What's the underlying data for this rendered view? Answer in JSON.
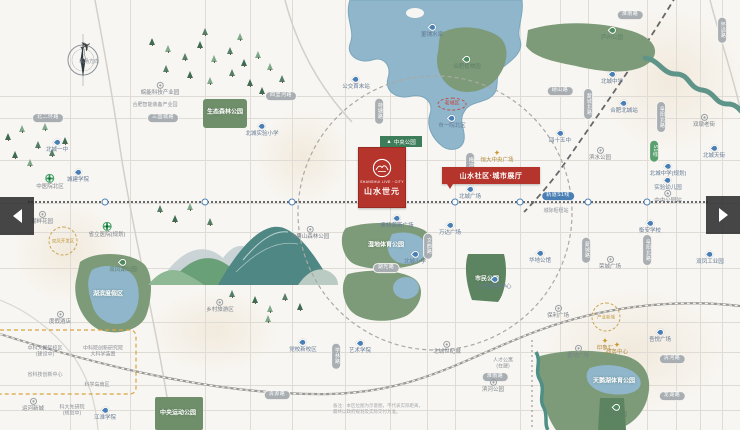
{
  "project": {
    "tag": "中央公园",
    "name_en": "SHANSHUI LIVE · CITY",
    "name_cn": "山水世元",
    "banner": "山水社区·城市展厅"
  },
  "disclaimer": {
    "line1": "备注：本区位图为示意图，不代表实际距离，",
    "line2": "最终以政府规划及实际交付为准。"
  },
  "metro": {
    "y": 201,
    "label": "轨道S1线",
    "stations": [
      105,
      205,
      292,
      390,
      455,
      520,
      588,
      647
    ]
  },
  "grid": {
    "v": [
      70,
      130,
      205,
      250,
      292,
      345,
      390,
      427,
      455,
      520,
      560,
      588,
      647,
      676,
      700,
      722
    ],
    "h": [
      96,
      118,
      160,
      203,
      232,
      268,
      322,
      352,
      385,
      410
    ]
  },
  "colors": {
    "accent_red": "#b5342c",
    "park_green": "#7d9b78",
    "lake_blue": "#8fb6ca",
    "pin_blue": "#4a7fb5"
  },
  "nav": {
    "prev_icon": "left-triangle",
    "next_icon": "right-triangle"
  },
  "labels": [
    {
      "x": 89,
      "y": 63,
      "k": "tx",
      "t": "机场方向"
    },
    {
      "x": 160,
      "y": 89,
      "k": "pc",
      "t": "皖能科技产业园"
    },
    {
      "x": 155,
      "y": 106,
      "k": "tx",
      "t": "合肥智能装备产业园"
    },
    {
      "x": 48,
      "y": 118,
      "k": "rh",
      "t": "北二环路"
    },
    {
      "x": 163,
      "y": 118,
      "k": "rh",
      "t": "三国城路"
    },
    {
      "x": 225,
      "y": 113,
      "k": "mw",
      "t": "生态森林公园"
    },
    {
      "x": 262,
      "y": 130,
      "k": "pb",
      "t": "北城实验小学"
    },
    {
      "x": 432,
      "y": 31,
      "k": "pb",
      "t": "董铺水库"
    },
    {
      "x": 467,
      "y": 63,
      "k": "pg",
      "t": "合肥植物园"
    },
    {
      "x": 356,
      "y": 83,
      "k": "pb",
      "t": "公交首末站"
    },
    {
      "x": 281,
      "y": 96,
      "k": "rh",
      "t": "四里河路"
    },
    {
      "x": 452,
      "y": 104,
      "k": "re",
      "t": "老城区"
    },
    {
      "x": 452,
      "y": 122,
      "k": "pb",
      "t": "市一院北区"
    },
    {
      "x": 560,
      "y": 91,
      "k": "rh",
      "t": "砀山路"
    },
    {
      "x": 612,
      "y": 34,
      "k": "pg",
      "t": "庐州公园"
    },
    {
      "x": 630,
      "y": 15,
      "k": "rh",
      "t": "淮南路"
    },
    {
      "x": 612,
      "y": 78,
      "k": "pb",
      "t": "北城中学"
    },
    {
      "x": 588,
      "y": 104,
      "k": "rv",
      "t": "蒙城北路"
    },
    {
      "x": 624,
      "y": 107,
      "k": "pb",
      "t": "合肥北城站"
    },
    {
      "x": 661,
      "y": 117,
      "k": "rv",
      "t": "阜阳北路"
    },
    {
      "x": 704,
      "y": 121,
      "k": "pc",
      "t": "双墩老街"
    },
    {
      "x": 722,
      "y": 30,
      "k": "rv",
      "t": "怀远路"
    },
    {
      "x": 560,
      "y": 137,
      "k": "pb",
      "t": "四十五中"
    },
    {
      "x": 600,
      "y": 154,
      "k": "pc",
      "t": "滨水公园"
    },
    {
      "x": 654,
      "y": 151,
      "k": "rg",
      "t": "S1线"
    },
    {
      "x": 668,
      "y": 170,
      "k": "pb",
      "t": "北城中学(规划)"
    },
    {
      "x": 668,
      "y": 184,
      "k": "pb",
      "t": "实验幼儿园"
    },
    {
      "x": 558,
      "y": 196,
      "k": "mt",
      "t": "轨道S1线"
    },
    {
      "x": 556,
      "y": 212,
      "k": "tx",
      "t": "城际枢纽站"
    },
    {
      "x": 668,
      "y": 197,
      "k": "pc",
      "t": "中央公园站"
    },
    {
      "x": 586,
      "y": 250,
      "k": "rv",
      "t": "蒙城路"
    },
    {
      "x": 647,
      "y": 250,
      "k": "rv",
      "t": "阜阳北路"
    },
    {
      "x": 650,
      "y": 227,
      "k": "pb",
      "t": "衡安学校"
    },
    {
      "x": 610,
      "y": 263,
      "k": "pc",
      "t": "荣城广场"
    },
    {
      "x": 714,
      "y": 152,
      "k": "pb",
      "t": "北城天街"
    },
    {
      "x": 710,
      "y": 258,
      "k": "pb",
      "t": "双凤工业园"
    },
    {
      "x": 379,
      "y": 111,
      "k": "rv",
      "t": "荷塘路"
    },
    {
      "x": 470,
      "y": 168,
      "k": "rv",
      "t": "梅冲湖路"
    },
    {
      "x": 497,
      "y": 157,
      "k": "st",
      "t": "恒大中央广场"
    },
    {
      "x": 470,
      "y": 193,
      "k": "pb",
      "t": "北城广场"
    },
    {
      "x": 397,
      "y": 222,
      "k": "pb",
      "t": "奥特莱斯广场"
    },
    {
      "x": 450,
      "y": 229,
      "k": "pb",
      "t": "万达广场"
    },
    {
      "x": 415,
      "y": 258,
      "k": "pb",
      "t": "北城小学"
    },
    {
      "x": 386,
      "y": 246,
      "k": "mw",
      "t": "湿地体育公园"
    },
    {
      "x": 487,
      "y": 280,
      "k": "mw",
      "t": "市民公园"
    },
    {
      "x": 540,
      "y": 257,
      "k": "pb",
      "t": "华地公馆"
    },
    {
      "x": 495,
      "y": 283,
      "k": "pb",
      "t": "社区服务中心"
    },
    {
      "x": 386,
      "y": 268,
      "k": "rh",
      "t": "湖光路"
    },
    {
      "x": 428,
      "y": 246,
      "k": "rv",
      "t": "文曲路"
    },
    {
      "x": 310,
      "y": 233,
      "k": "pc",
      "t": "大蜀山森林公园"
    },
    {
      "x": 57,
      "y": 146,
      "k": "pb",
      "t": "北城一中"
    },
    {
      "x": 50,
      "y": 182,
      "k": "hp",
      "t": "中医院北区"
    },
    {
      "x": 78,
      "y": 176,
      "k": "pb",
      "t": "城建学院"
    },
    {
      "x": 107,
      "y": 230,
      "k": "hp",
      "t": "省立医院(规划)"
    },
    {
      "x": 42,
      "y": 218,
      "k": "pc",
      "t": "湖畔花园"
    },
    {
      "x": 63,
      "y": 241,
      "k": "gd",
      "t": "双凤开发区"
    },
    {
      "x": 123,
      "y": 266,
      "k": "pg",
      "t": "双凤湖公园"
    },
    {
      "x": 108,
      "y": 295,
      "k": "mw",
      "t": "湖滨度假区"
    },
    {
      "x": 60,
      "y": 318,
      "k": "pc",
      "t": "度假酒店"
    },
    {
      "x": 45,
      "y": 352,
      "k": "t2",
      "t": "中科大国际校区\n(建设中)"
    },
    {
      "x": 103,
      "y": 352,
      "k": "t2",
      "t": "中科院创新研究院\n大科学装置"
    },
    {
      "x": 45,
      "y": 376,
      "k": "tx",
      "t": "省科技创新中心"
    },
    {
      "x": 97,
      "y": 386,
      "k": "tx",
      "t": "科学岛南区"
    },
    {
      "x": 33,
      "y": 405,
      "k": "pc",
      "t": "运河新城"
    },
    {
      "x": 72,
      "y": 411,
      "k": "t2",
      "t": "科大先研院\n(规划中)"
    },
    {
      "x": 105,
      "y": 414,
      "k": "pb",
      "t": "江淮学院"
    },
    {
      "x": 178,
      "y": 414,
      "k": "mw",
      "t": "中央运动公园"
    },
    {
      "x": 220,
      "y": 306,
      "k": "pc",
      "t": "乡村旅游区"
    },
    {
      "x": 303,
      "y": 346,
      "k": "pb",
      "t": "党校新校区"
    },
    {
      "x": 360,
      "y": 347,
      "k": "pb",
      "t": "艺术学院"
    },
    {
      "x": 277,
      "y": 395,
      "k": "rh",
      "t": "清源路"
    },
    {
      "x": 336,
      "y": 356,
      "k": "rv",
      "t": "学林路"
    },
    {
      "x": 447,
      "y": 348,
      "k": "pc",
      "t": "北城世纪城"
    },
    {
      "x": 503,
      "y": 364,
      "k": "t2",
      "t": "人才公寓\n(在建)"
    },
    {
      "x": 495,
      "y": 377,
      "k": "rh",
      "t": "淮南路"
    },
    {
      "x": 493,
      "y": 386,
      "k": "pc",
      "t": "滨河公园"
    },
    {
      "x": 605,
      "y": 345,
      "k": "st",
      "t": "印象汇"
    },
    {
      "x": 558,
      "y": 312,
      "k": "pc",
      "t": "保利广场"
    },
    {
      "x": 606,
      "y": 317,
      "k": "gd",
      "t": "产业新城"
    },
    {
      "x": 617,
      "y": 349,
      "k": "st",
      "t": "政务中心"
    },
    {
      "x": 578,
      "y": 352,
      "k": "pc",
      "t": "置地广场"
    },
    {
      "x": 660,
      "y": 336,
      "k": "pb",
      "t": "吾悦广场"
    },
    {
      "x": 672,
      "y": 359,
      "k": "rh",
      "t": "清河路"
    },
    {
      "x": 672,
      "y": 396,
      "k": "rh",
      "t": "龙湖路"
    },
    {
      "x": 614,
      "y": 382,
      "k": "mw",
      "t": "天鹅湖体育公园"
    },
    {
      "x": 616,
      "y": 411,
      "k": "pg",
      "t": "湿地公园"
    }
  ],
  "trees": [
    [
      152,
      45
    ],
    [
      168,
      52
    ],
    [
      185,
      60
    ],
    [
      200,
      48
    ],
    [
      214,
      62
    ],
    [
      230,
      54
    ],
    [
      244,
      66
    ],
    [
      258,
      58
    ],
    [
      166,
      72
    ],
    [
      190,
      78
    ],
    [
      210,
      84
    ],
    [
      232,
      76
    ],
    [
      250,
      86
    ],
    [
      270,
      70
    ],
    [
      282,
      82
    ],
    [
      262,
      94
    ],
    [
      240,
      40
    ],
    [
      205,
      35
    ],
    [
      8,
      140
    ],
    [
      22,
      132
    ],
    [
      38,
      148
    ],
    [
      15,
      158
    ],
    [
      30,
      166
    ],
    [
      52,
      156
    ],
    [
      65,
      144
    ],
    [
      45,
      130
    ],
    [
      160,
      212
    ],
    [
      175,
      222
    ],
    [
      190,
      210
    ],
    [
      210,
      225
    ],
    [
      255,
      303
    ],
    [
      270,
      312
    ],
    [
      285,
      300
    ],
    [
      300,
      310
    ],
    [
      268,
      322
    ],
    [
      232,
      297
    ]
  ]
}
